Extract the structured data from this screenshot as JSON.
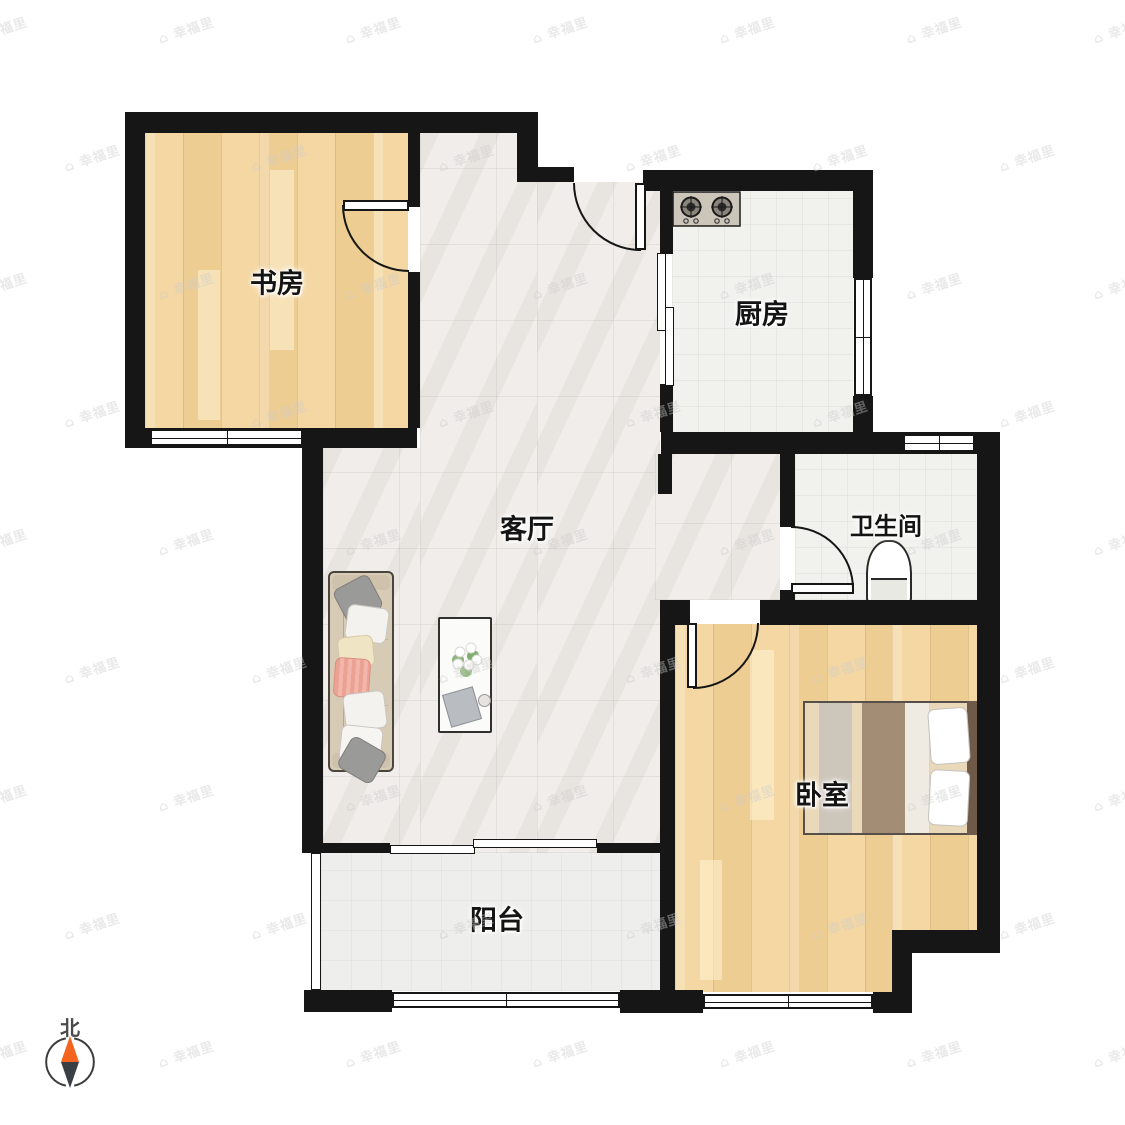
{
  "watermark": {
    "text": "幸福里",
    "logo_glyph": "⌂"
  },
  "compass": {
    "north_label": "北",
    "needle_north_color": "#f4641e",
    "needle_south_color": "#3a3f46"
  },
  "rooms": {
    "study": {
      "label": "书房"
    },
    "kitchen": {
      "label": "厨房"
    },
    "living": {
      "label": "客厅"
    },
    "bathroom": {
      "label": "卫生间"
    },
    "bedroom": {
      "label": "卧室"
    },
    "balcony": {
      "label": "阳台"
    }
  },
  "colors": {
    "wall": "#161616",
    "wood_floor": "#f1d29c",
    "marble_floor": "#f0edea",
    "tile_floor": "#f1f1ee",
    "watermark_gray": "#cccccc"
  }
}
